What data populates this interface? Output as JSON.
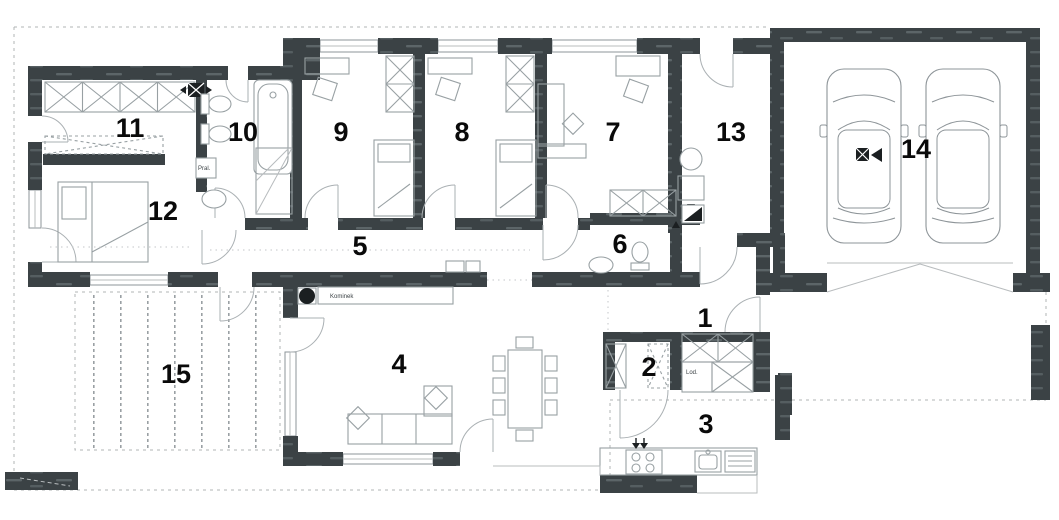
{
  "plan": {
    "type": "house-floor-plan",
    "rooms": [
      {
        "number": "1"
      },
      {
        "number": "2"
      },
      {
        "number": "3"
      },
      {
        "number": "4"
      },
      {
        "number": "5"
      },
      {
        "number": "6"
      },
      {
        "number": "7"
      },
      {
        "number": "8"
      },
      {
        "number": "9"
      },
      {
        "number": "10"
      },
      {
        "number": "11"
      },
      {
        "number": "12"
      },
      {
        "number": "13"
      },
      {
        "number": "14"
      },
      {
        "number": "15"
      }
    ],
    "annotations": {
      "fireplace": "Kominek",
      "fridge": "Lod.",
      "washer": "Pral."
    },
    "colors": {
      "wall": "#3b4245",
      "wall_streak": "#5c6568",
      "line": "#98a0a3",
      "dash": "#b0b4b6",
      "text": "#0a0a0a",
      "background": "#ffffff"
    }
  }
}
